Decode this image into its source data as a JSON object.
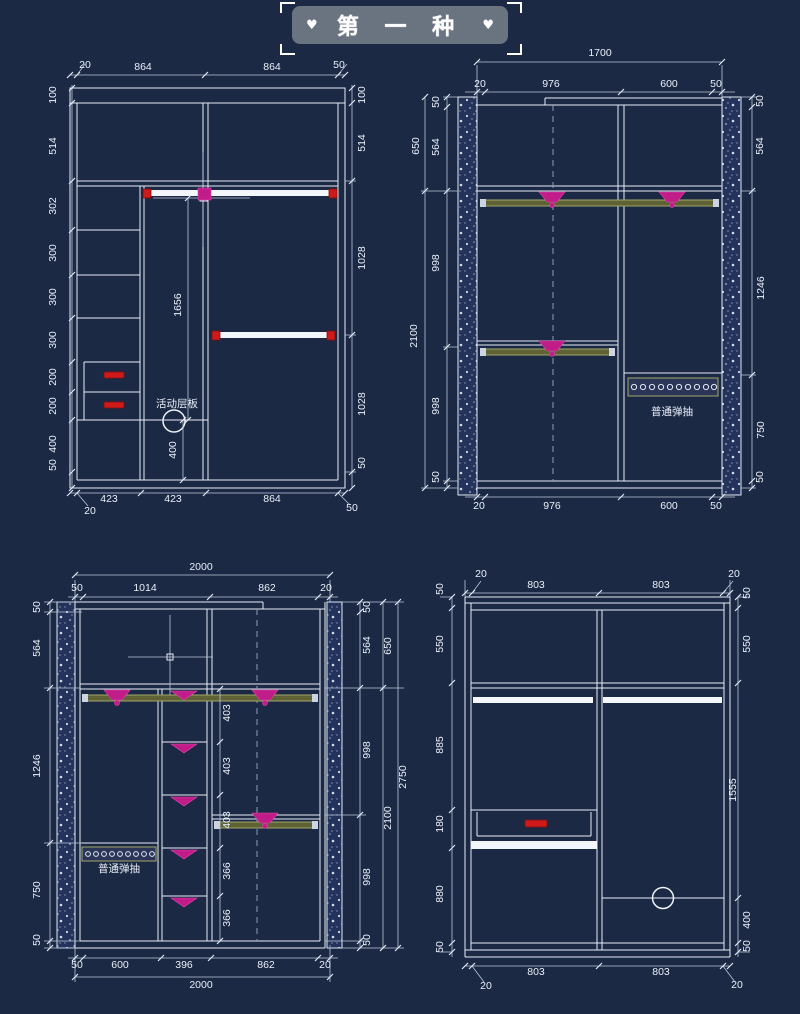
{
  "title": {
    "text": "第 一 种",
    "heart": "♥"
  },
  "colors": {
    "background": "#1c2944",
    "line": "#e7edf6",
    "banner_grey": "#6a7380",
    "handle_red": "#ce1a1a",
    "bracket_magenta": "#c01d89",
    "rod_olive": "#5f6234"
  },
  "panels": {
    "top_left": {
      "name": "wardrobe-elevation-1",
      "labels": [
        {
          "t": "20",
          "x": 85,
          "y": 68
        },
        {
          "t": "864",
          "x": 143,
          "y": 70
        },
        {
          "t": "864",
          "x": 272,
          "y": 70
        },
        {
          "t": "50",
          "x": 339,
          "y": 68
        },
        {
          "t": "100",
          "x": 56,
          "y": 95,
          "r": -90
        },
        {
          "t": "514",
          "x": 56,
          "y": 146,
          "r": -90
        },
        {
          "t": "302",
          "x": 56,
          "y": 206,
          "r": -90
        },
        {
          "t": "300",
          "x": 56,
          "y": 253,
          "r": -90
        },
        {
          "t": "300",
          "x": 56,
          "y": 297,
          "r": -90
        },
        {
          "t": "300",
          "x": 56,
          "y": 340,
          "r": -90
        },
        {
          "t": "200",
          "x": 56,
          "y": 377,
          "r": -90
        },
        {
          "t": "200",
          "x": 56,
          "y": 406,
          "r": -90
        },
        {
          "t": "400",
          "x": 56,
          "y": 444,
          "r": -90
        },
        {
          "t": "50",
          "x": 56,
          "y": 465,
          "r": -90
        },
        {
          "t": "100",
          "x": 365,
          "y": 95,
          "r": -90
        },
        {
          "t": "514",
          "x": 365,
          "y": 143,
          "r": -90
        },
        {
          "t": "1028",
          "x": 365,
          "y": 258,
          "r": -90
        },
        {
          "t": "1028",
          "x": 365,
          "y": 404,
          "r": -90
        },
        {
          "t": "50",
          "x": 365,
          "y": 463,
          "r": -90
        },
        {
          "t": "1656",
          "x": 181,
          "y": 305,
          "r": -90
        },
        {
          "t": "400",
          "x": 176,
          "y": 450,
          "r": -90
        },
        {
          "t": "活动层板",
          "x": 177,
          "y": 407,
          "s": 13,
          "cn": true
        },
        {
          "t": "423",
          "x": 109,
          "y": 502
        },
        {
          "t": "423",
          "x": 173,
          "y": 502
        },
        {
          "t": "864",
          "x": 272,
          "y": 502
        },
        {
          "t": "20",
          "x": 90,
          "y": 514
        },
        {
          "t": "50",
          "x": 352,
          "y": 511
        }
      ]
    },
    "top_right": {
      "name": "wardrobe-elevation-2",
      "labels": [
        {
          "t": "1700",
          "x": 600,
          "y": 56
        },
        {
          "t": "20",
          "x": 480,
          "y": 87
        },
        {
          "t": "976",
          "x": 551,
          "y": 87
        },
        {
          "t": "600",
          "x": 669,
          "y": 87
        },
        {
          "t": "50",
          "x": 716,
          "y": 87
        },
        {
          "t": "650",
          "x": 419,
          "y": 146,
          "r": -90
        },
        {
          "t": "2100",
          "x": 417,
          "y": 336,
          "r": -90
        },
        {
          "t": "50",
          "x": 439,
          "y": 102,
          "r": -90
        },
        {
          "t": "564",
          "x": 439,
          "y": 147,
          "r": -90
        },
        {
          "t": "998",
          "x": 439,
          "y": 263,
          "r": -90
        },
        {
          "t": "998",
          "x": 439,
          "y": 406,
          "r": -90
        },
        {
          "t": "50",
          "x": 439,
          "y": 477,
          "r": -90
        },
        {
          "t": "50",
          "x": 763,
          "y": 101,
          "r": -90
        },
        {
          "t": "564",
          "x": 763,
          "y": 146,
          "r": -90
        },
        {
          "t": "1246",
          "x": 764,
          "y": 288,
          "r": -90
        },
        {
          "t": "750",
          "x": 764,
          "y": 430,
          "r": -90
        },
        {
          "t": "50",
          "x": 763,
          "y": 477,
          "r": -90
        },
        {
          "t": "20",
          "x": 479,
          "y": 509
        },
        {
          "t": "976",
          "x": 552,
          "y": 509
        },
        {
          "t": "600",
          "x": 669,
          "y": 509
        },
        {
          "t": "50",
          "x": 716,
          "y": 509
        },
        {
          "t": "普通弹抽",
          "x": 672,
          "y": 415,
          "s": 11,
          "cn": true
        }
      ]
    },
    "bottom_left": {
      "name": "wardrobe-elevation-3",
      "labels": [
        {
          "t": "2000",
          "x": 201,
          "y": 570
        },
        {
          "t": "50",
          "x": 77,
          "y": 591
        },
        {
          "t": "1014",
          "x": 145,
          "y": 591
        },
        {
          "t": "862",
          "x": 267,
          "y": 591
        },
        {
          "t": "20",
          "x": 326,
          "y": 591
        },
        {
          "t": "50",
          "x": 40,
          "y": 607,
          "r": -90
        },
        {
          "t": "564",
          "x": 40,
          "y": 648,
          "r": -90
        },
        {
          "t": "1246",
          "x": 40,
          "y": 766,
          "r": -90
        },
        {
          "t": "750",
          "x": 40,
          "y": 890,
          "r": -90
        },
        {
          "t": "50",
          "x": 40,
          "y": 940,
          "r": -90
        },
        {
          "t": "50",
          "x": 370,
          "y": 607,
          "r": -90
        },
        {
          "t": "564",
          "x": 370,
          "y": 645,
          "r": -90
        },
        {
          "t": "998",
          "x": 370,
          "y": 750,
          "r": -90
        },
        {
          "t": "998",
          "x": 370,
          "y": 877,
          "r": -90
        },
        {
          "t": "50",
          "x": 370,
          "y": 940,
          "r": -90
        },
        {
          "t": "650",
          "x": 391,
          "y": 646,
          "r": -90
        },
        {
          "t": "2100",
          "x": 391,
          "y": 818,
          "r": -90
        },
        {
          "t": "2750",
          "x": 406,
          "y": 777,
          "r": -90
        },
        {
          "t": "403",
          "x": 230,
          "y": 713,
          "r": -90
        },
        {
          "t": "403",
          "x": 230,
          "y": 766,
          "r": -90
        },
        {
          "t": "403",
          "x": 230,
          "y": 820,
          "r": -90
        },
        {
          "t": "366",
          "x": 230,
          "y": 871,
          "r": -90
        },
        {
          "t": "366",
          "x": 230,
          "y": 918,
          "r": -90
        },
        {
          "t": "普通弹抽",
          "x": 119,
          "y": 872,
          "s": 11,
          "cn": true
        },
        {
          "t": "50",
          "x": 77,
          "y": 968
        },
        {
          "t": "600",
          "x": 120,
          "y": 968
        },
        {
          "t": "396",
          "x": 184,
          "y": 968
        },
        {
          "t": "862",
          "x": 266,
          "y": 968
        },
        {
          "t": "20",
          "x": 325,
          "y": 968
        },
        {
          "t": "2000",
          "x": 201,
          "y": 988
        }
      ]
    },
    "bottom_right": {
      "name": "wardrobe-elevation-4",
      "labels": [
        {
          "t": "20",
          "x": 481,
          "y": 577
        },
        {
          "t": "803",
          "x": 536,
          "y": 588
        },
        {
          "t": "803",
          "x": 661,
          "y": 588
        },
        {
          "t": "20",
          "x": 734,
          "y": 577
        },
        {
          "t": "50",
          "x": 443,
          "y": 589,
          "r": -90
        },
        {
          "t": "50",
          "x": 750,
          "y": 593,
          "r": -90
        },
        {
          "t": "550",
          "x": 443,
          "y": 644,
          "r": -90
        },
        {
          "t": "885",
          "x": 443,
          "y": 745,
          "r": -90
        },
        {
          "t": "180",
          "x": 443,
          "y": 824,
          "r": -90
        },
        {
          "t": "880",
          "x": 443,
          "y": 894,
          "r": -90
        },
        {
          "t": "50",
          "x": 443,
          "y": 947,
          "r": -90
        },
        {
          "t": "550",
          "x": 750,
          "y": 644,
          "r": -90
        },
        {
          "t": "1555",
          "x": 736,
          "y": 790,
          "r": -90
        },
        {
          "t": "400",
          "x": 750,
          "y": 920,
          "r": -90
        },
        {
          "t": "50",
          "x": 750,
          "y": 946,
          "r": -90
        },
        {
          "t": "803",
          "x": 536,
          "y": 975
        },
        {
          "t": "803",
          "x": 661,
          "y": 975
        },
        {
          "t": "20",
          "x": 486,
          "y": 989
        },
        {
          "t": "20",
          "x": 737,
          "y": 988
        }
      ]
    }
  }
}
